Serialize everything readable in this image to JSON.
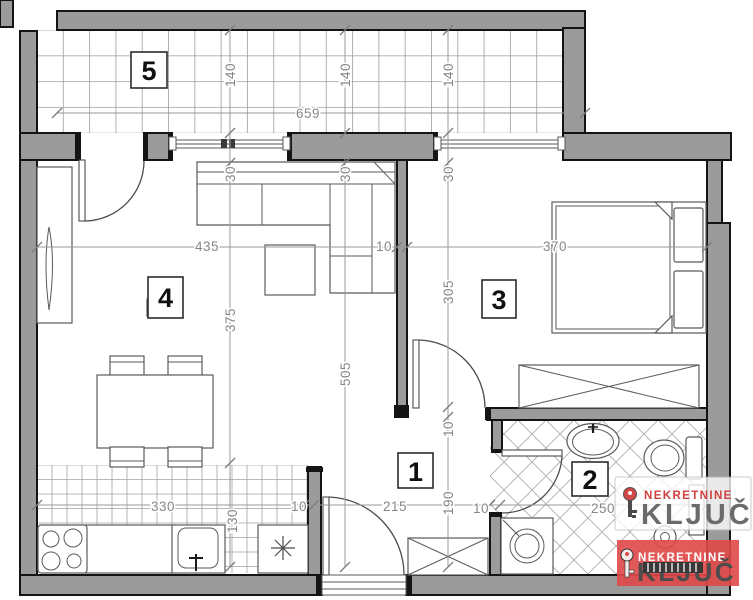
{
  "plan_title": "apartment-floor-plan",
  "rooms": {
    "hall_label": "1",
    "bathroom_label": "2",
    "bedroom_label": "3",
    "living_label": "4",
    "balcony_label": "5"
  },
  "dimensions": {
    "balcony_width": "659",
    "balcony_depth_1": "140",
    "balcony_depth_2": "140",
    "balcony_depth_3": "140",
    "wall_30_1": "30",
    "wall_30_2": "30",
    "wall_30_3": "30",
    "living_width": "435",
    "divider_wall": "10",
    "bedroom_width": "370",
    "living_depth": "375",
    "total_depth": "505",
    "bedroom_depth": "305",
    "kitchen_run": "330",
    "kitchen_wall": "10",
    "kitchen_depth": "130",
    "hall_width": "215",
    "hall_depth": "190",
    "hall_wall": "10",
    "bath_wall": "10",
    "bathroom_width": "250"
  },
  "logos": {
    "watermark": {
      "brand_top": "NEKRETNINE",
      "brand_main": "KLJUČ"
    },
    "badge": {
      "brand_top": "NEKRETNINE",
      "brand_main": "KLJUČ"
    }
  },
  "colors": {
    "brand_red": "#d64545",
    "badge_bg": "#e04848",
    "logo_gray": "#6b6b6b",
    "wall_gray": "#9b9b9b"
  }
}
